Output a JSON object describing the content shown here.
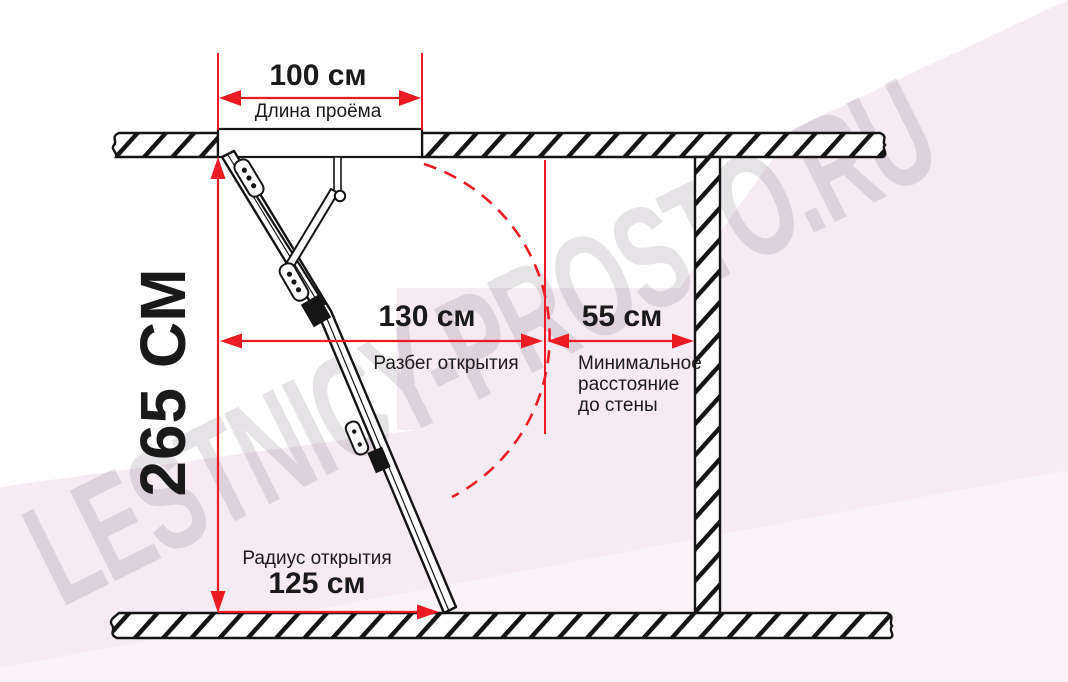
{
  "watermark": {
    "text": "LESTNICY-PROSTO.RU"
  },
  "dimensions": {
    "opening_length": {
      "value": "100 см",
      "label": "Длина проёма"
    },
    "ceiling_height": {
      "value": "265 СМ"
    },
    "opening_run": {
      "value": "130 см",
      "label": "Разбег открытия"
    },
    "wall_clearance": {
      "value": "55 см",
      "label": "Минимальное расстояние до стены"
    },
    "opening_radius": {
      "value": "125 см",
      "label": "Радиус открытия"
    }
  },
  "colors": {
    "dimension_red": "#ed1c24",
    "line_black": "#141414",
    "background_pink": "#f6ebf3",
    "watermark_gray": "rgba(73,55,78,0.14)"
  }
}
